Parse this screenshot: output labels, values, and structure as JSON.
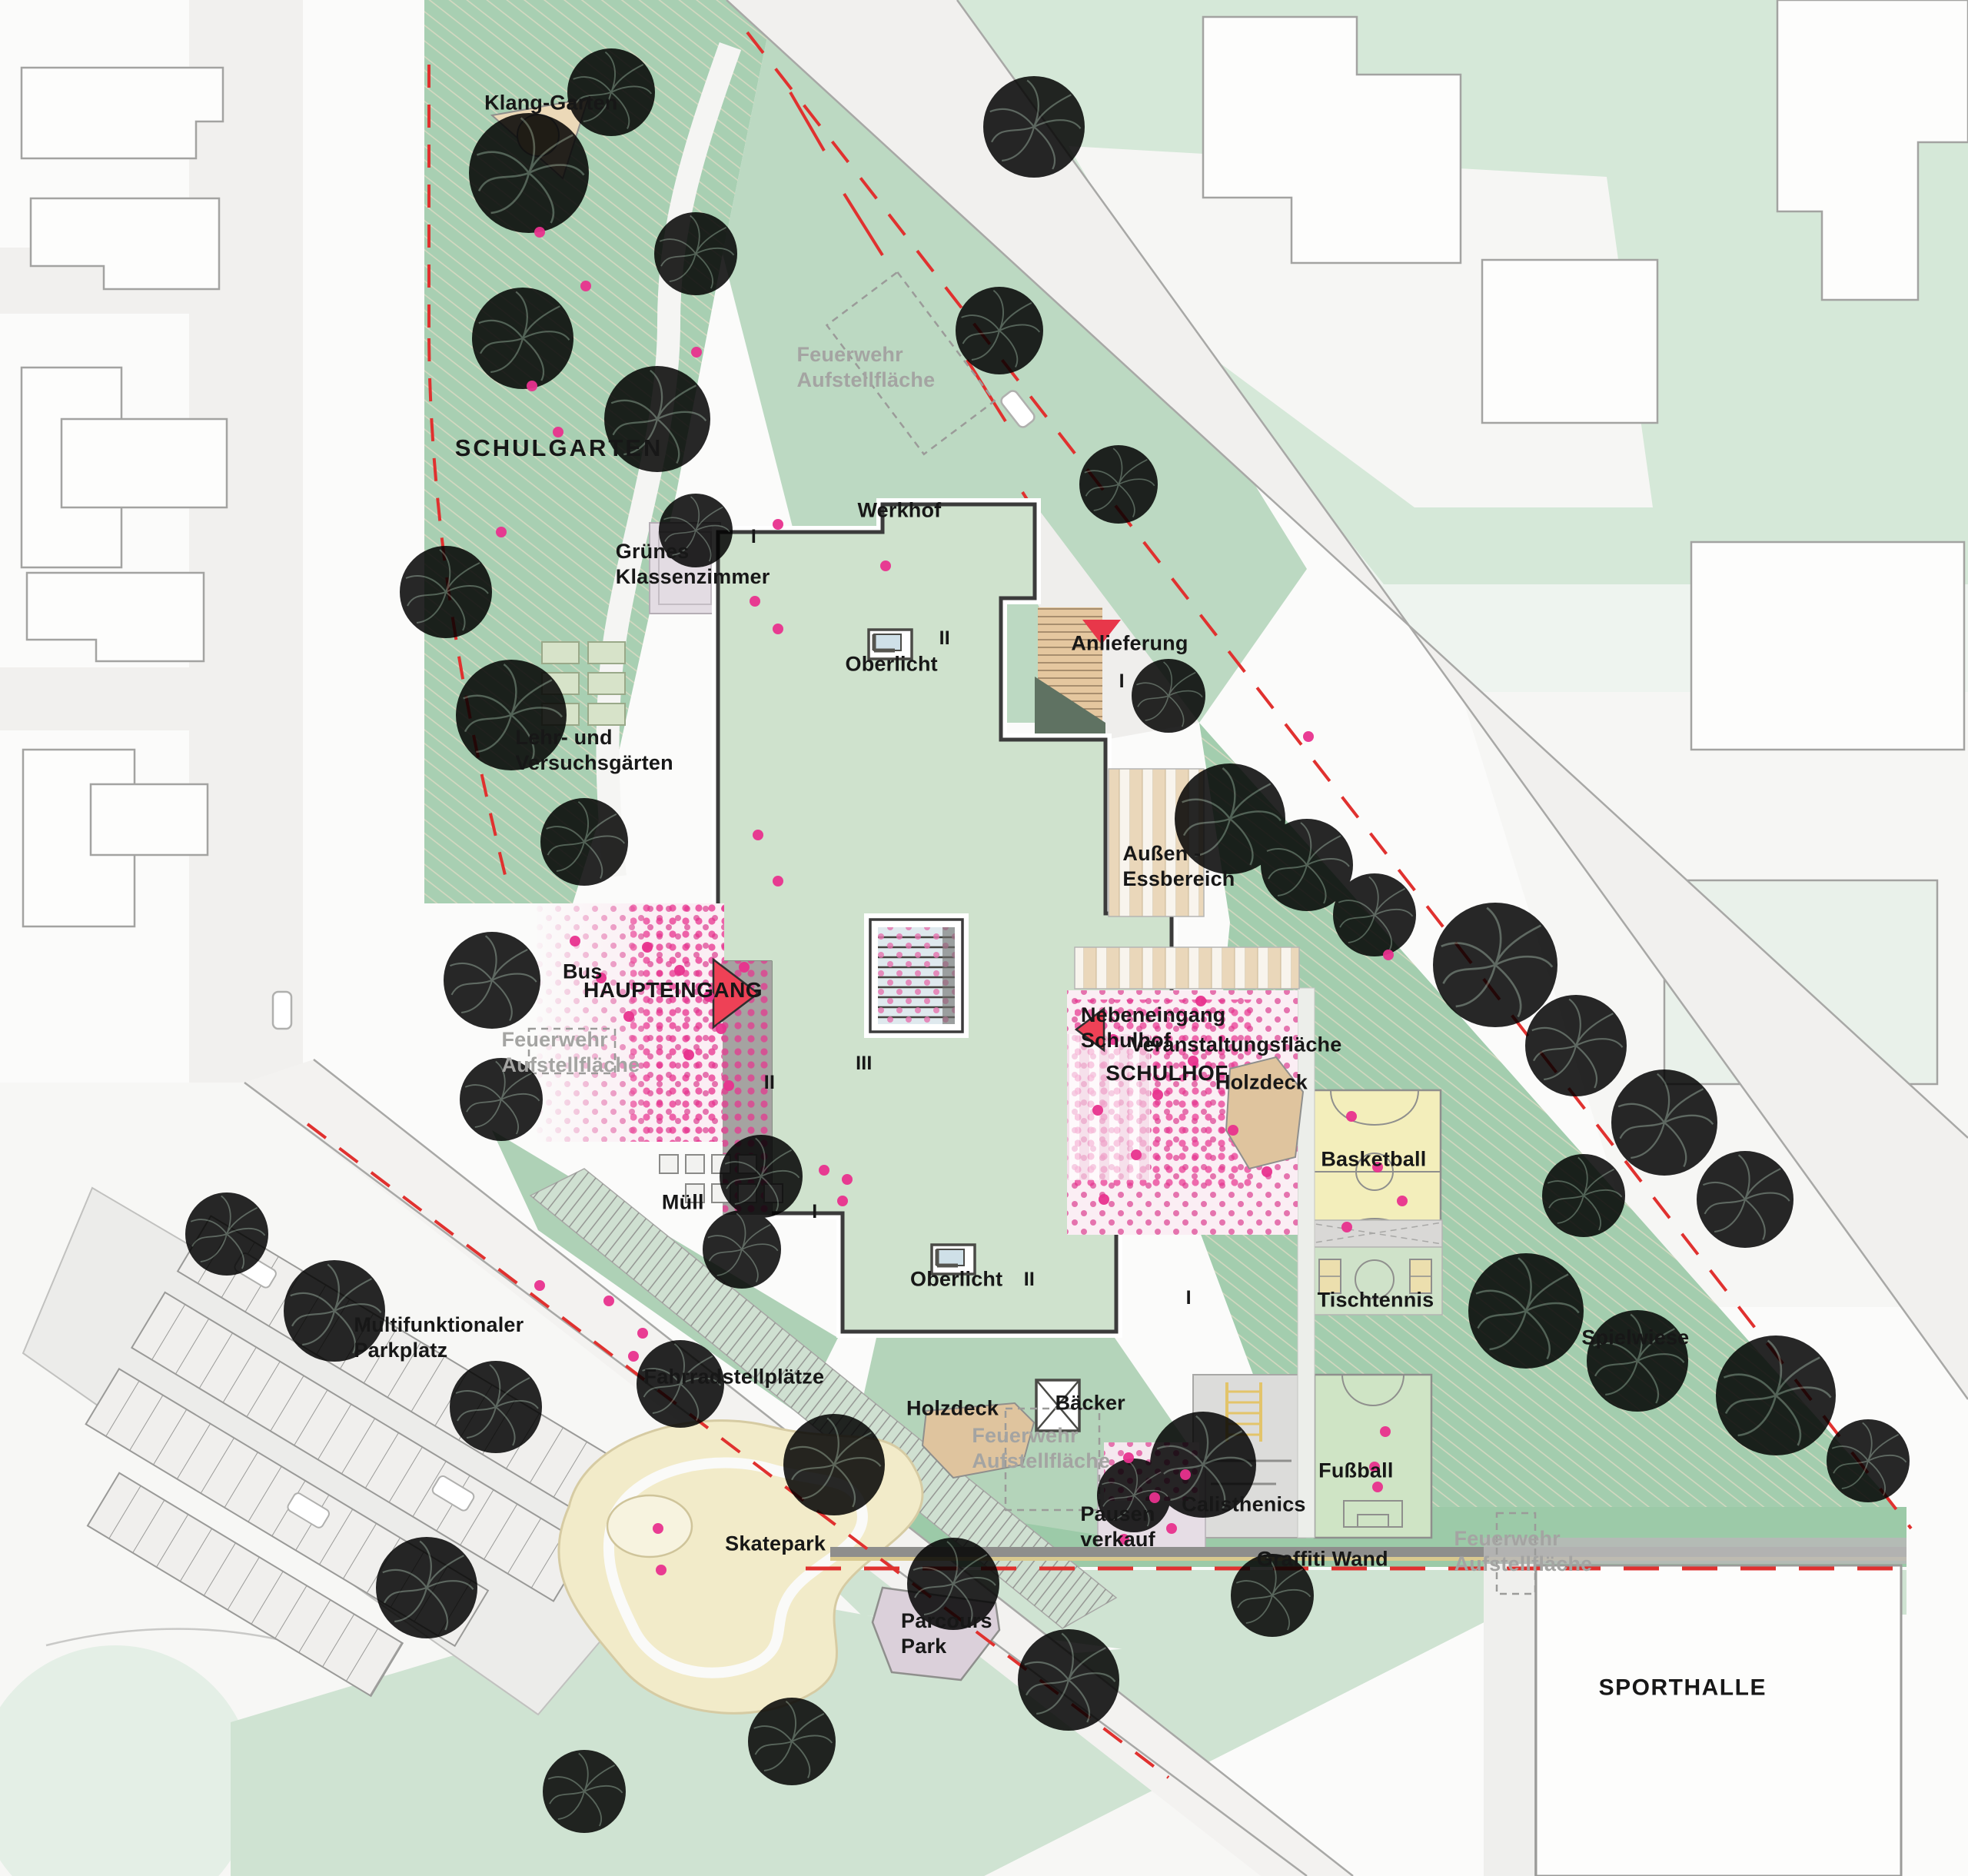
{
  "labels": {
    "klang_garten": "Klang-Garten",
    "schulgarten": "SCHULGARTEN",
    "feuerwehr_aufstellflaeche": "Feuerwehr\nAufstellfläche",
    "werkhof": "Werkhof",
    "gruenes_klassenzimmer": "Grünes\nKlassenzimmer",
    "oberlicht": "Oberlicht",
    "anlieferung": "Anlieferung",
    "lehr_und_versuchsgaerten": "Lehr- und\nVersuchsgärten",
    "aussen_essbereich": "Außen -\nEssbereich",
    "bus": "Bus",
    "haupteingang": "HAUPTEINGANG",
    "nebeneingang_schulhof": "Nebeneingang\nSchulhof",
    "veranstaltungsflaeche": "Veranstaltungsfläche",
    "schulhof": "SCHULHOF",
    "holzdeck": "Holzdeck",
    "basketball": "Basketball",
    "tischtennis": "Tischtennis",
    "muell": "Müll",
    "spielwiese": "Spielwiese",
    "multifunktionaler_parkplatz": "Multifunktionaler\nParkplatz",
    "fahrradstellplaetze": "Fahrradstellplätze",
    "baecker": "Bäcker",
    "pausenverkauf": "Pausen\nverkauf",
    "calisthenics": "Calisthenics",
    "fussball": "Fußball",
    "graffiti_wand": "Graffiti Wand",
    "skatepark": "Skatepark",
    "parcours_park": "Parcours\nPark",
    "sporthalle": "SPORTHALLE",
    "level_1": "I",
    "level_2": "II",
    "level_3": "III"
  },
  "colors": {
    "park_green": "#a8cfb2",
    "light_green": "#cfe3d2",
    "roof_green": "#cfe2cd",
    "wood_tan": "#e5c79f",
    "plaza_pink": "#fbeef4",
    "dot_magenta": "#e8328e",
    "accent_red": "#e0312f",
    "court_yellow": "#f3eebb",
    "road_gray": "#f1f0ee",
    "label_gray": "#a4a4a2"
  }
}
